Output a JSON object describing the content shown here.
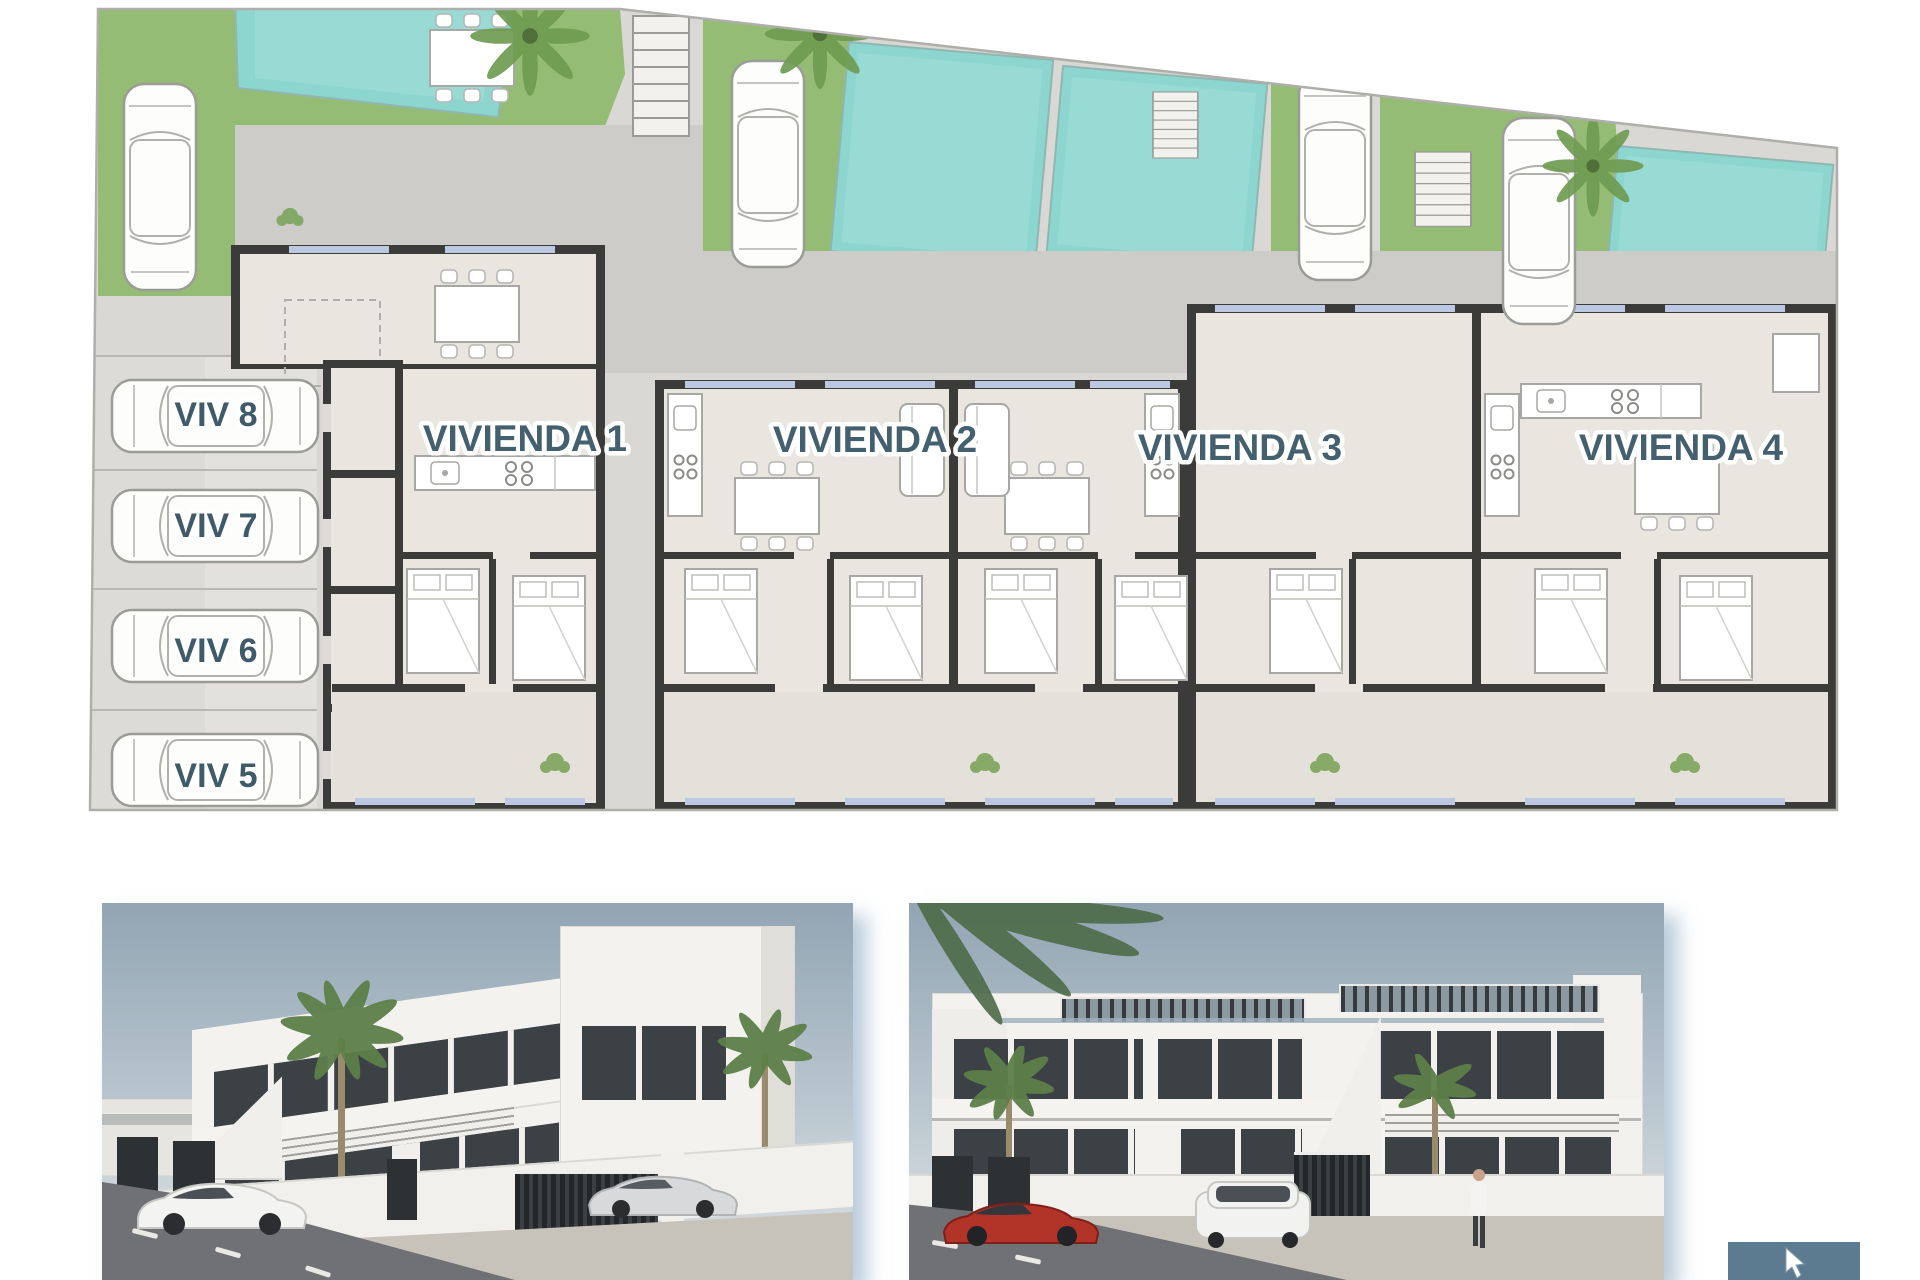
{
  "floor_plan": {
    "unit_labels": [
      "VIVIENDA 1",
      "VIVIENDA 2",
      "VIVIENDA 3",
      "VIVIENDA 4"
    ],
    "parking_labels": [
      "VIV 8",
      "VIV 7",
      "VIV 6",
      "VIV 5"
    ],
    "colors": {
      "label_text": "#44606e",
      "pool_water": "#8dd6cf",
      "grass": "#95bc74",
      "wall": "#3b3b39",
      "interior_floor": "#e9e5df",
      "terrace_floor": "#e4e1db",
      "pavement": "#d9d8d4",
      "walkway": "#cdccc8",
      "parking_strip": "#dcdbd8",
      "window_glazing": "#bcc8e2"
    }
  },
  "renders": {
    "colors": {
      "sky": "#92a5b3",
      "building_white": "#f3f2ef",
      "glass_dark": "#3c4146",
      "asphalt": "#6f7174",
      "sidewalk": "#c8c3ba",
      "red_car": "#b23327",
      "palm_green": "#5d7f52"
    }
  },
  "cursor_overlay": {
    "background": "#5d7b90"
  },
  "icons": {
    "car-icon": "top-view car outline",
    "palm-icon": "palm tree canopy",
    "stairs-icon": "staircase with treads",
    "shrub-icon": "small plant",
    "cursor-icon": "mouse pointer arrow"
  }
}
